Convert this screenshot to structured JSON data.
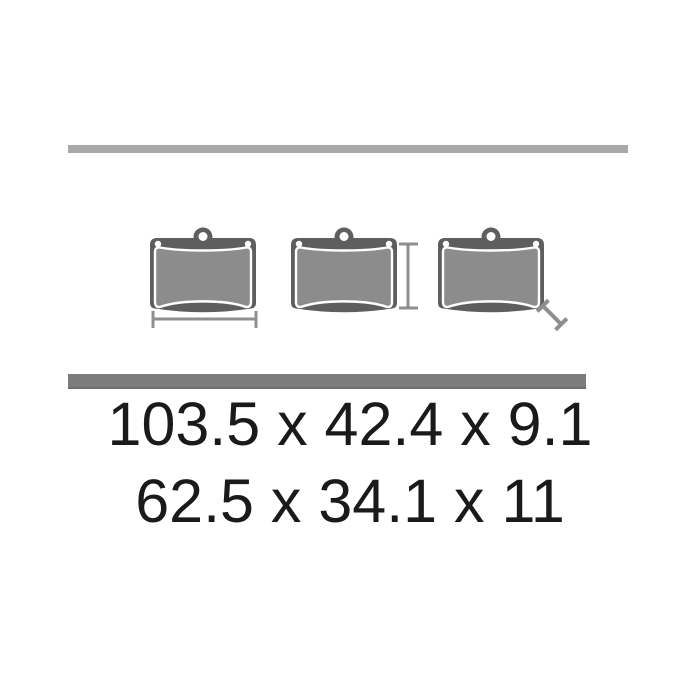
{
  "page": {
    "background_color": "#ffffff",
    "description": "Brake pad set technical diagram with dimensions"
  },
  "dividers": {
    "top_bar_color": "#a8a8a8",
    "bottom_bar_color": "#7c7c7c"
  },
  "diagram": {
    "pad_count": 3,
    "pads": [
      {
        "label": "brake-pad-left",
        "indicator": "width"
      },
      {
        "label": "brake-pad-middle",
        "indicator": "height"
      },
      {
        "label": "brake-pad-right",
        "indicator": "thickness"
      }
    ],
    "colors": {
      "backing_plate": "#5e5e5e",
      "friction_material": "#8c8c8c",
      "pad_outline": "#ffffff",
      "dimension_line": "#8f8f8f"
    }
  },
  "dimensions": {
    "line1": "103.5 x 42.4 x 9.1",
    "line2": "62.5 x 34.1 x 11",
    "text_color": "#1a1a1a"
  }
}
